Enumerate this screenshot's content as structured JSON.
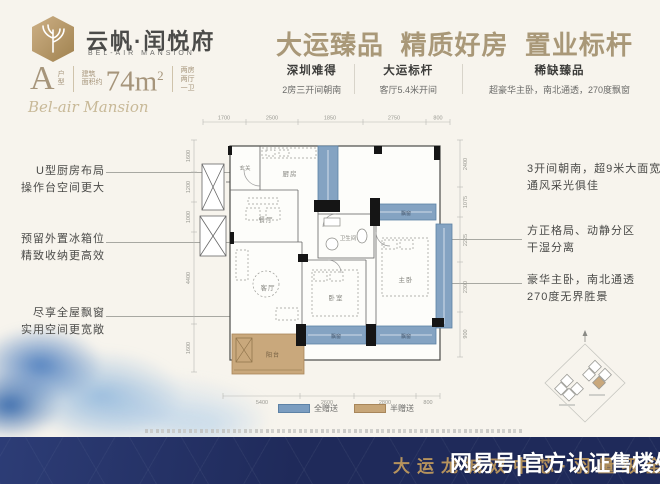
{
  "colors": {
    "accent_gold": "#a99878",
    "navy_banner": "#1f2a5a",
    "bay_blue": "#7b9dc0",
    "balcony_tan": "#c7a678",
    "banner_gold": "#b6935d"
  },
  "brand": {
    "logo_cn": "云帆·闰悦府",
    "logo_en": "BEL-AIR MANSION",
    "script": "Bel-air Mansion",
    "unit_letter": "A",
    "unit_label_1": "户",
    "unit_label_2": "型",
    "area_pre_1": "建筑",
    "area_pre_2": "面积约",
    "area_base": "74m",
    "area_exp": "2",
    "layout_1": "两房",
    "layout_2": "两厅",
    "layout_3": "一卫"
  },
  "headline": "大运臻品  精质好房  置业标杆",
  "selling_points": [
    {
      "title": "深圳难得",
      "desc": "2房三开间朝南"
    },
    {
      "title": "大运标杆",
      "desc": "客厅5.4米开间"
    },
    {
      "title": "稀缺臻品",
      "desc": "超豪华主卧，南北通透，270度飘窗"
    }
  ],
  "callouts_left": [
    {
      "l1": "U型厨房布局",
      "l2": "操作台空间更大"
    },
    {
      "l1": "预留外置冰箱位",
      "l2": "精致收纳更高效"
    },
    {
      "l1": "尽享全屋飘窗",
      "l2": "实用空间更宽敞"
    }
  ],
  "callouts_right": [
    {
      "l1": "3开间朝南，超9米大面宽",
      "l2": "通风采光俱佳"
    },
    {
      "l1": "方正格局、动静分区",
      "l2": "干湿分离"
    },
    {
      "l1": "豪华主卧，南北通透",
      "l2": "270度无界胜景"
    }
  ],
  "plan": {
    "rooms": {
      "entry": "玄关",
      "kitchen": "厨房",
      "dining": "餐厅",
      "bath": "卫生间",
      "living": "客厅",
      "bedroom": "卧室",
      "master": "主卧",
      "balcony": "阳台",
      "bay": "飘窗"
    },
    "dims_top": [
      "1700",
      "2500",
      "1850",
      "2750",
      "800"
    ],
    "dims_bottom": [
      "5400",
      "2600",
      "2800",
      "800"
    ],
    "dims_left": [
      "1600",
      "1200",
      "1000",
      "4400",
      "1600"
    ],
    "dims_right": [
      "2400",
      "1075",
      "2225",
      "2300",
      "900"
    ],
    "legend": [
      {
        "label": "全赠送"
      },
      {
        "label": "半赠送"
      }
    ]
  },
  "footer": {
    "slogan": "大运龙城双中芯·羽量级全享轻奢",
    "watermark": "网易号|官方认证售楼处"
  }
}
